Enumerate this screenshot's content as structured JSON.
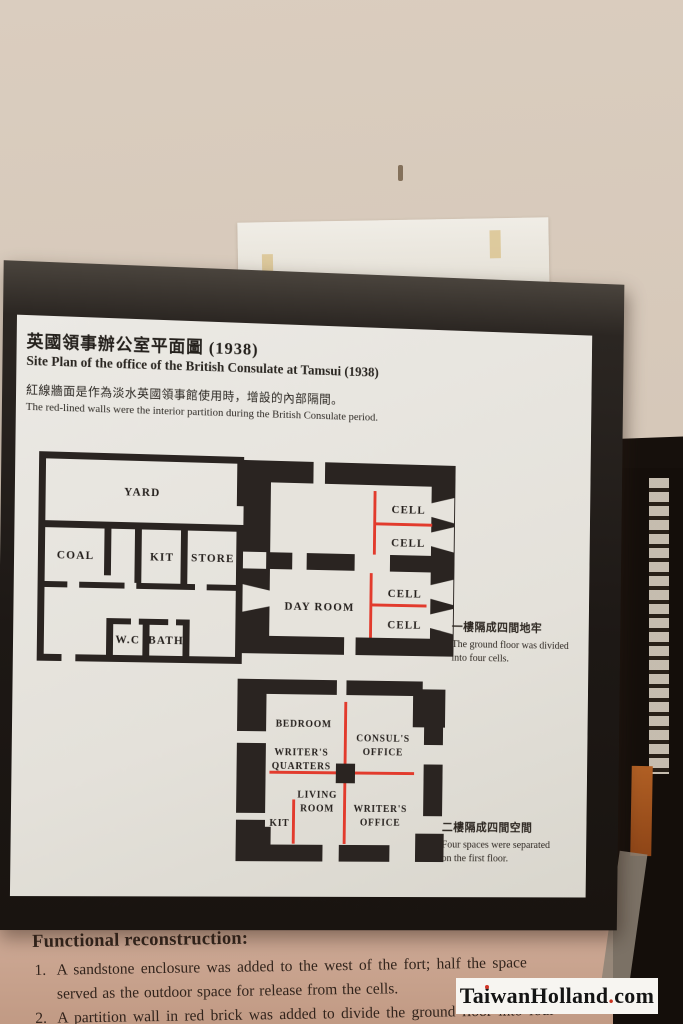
{
  "board": {
    "title_zh": "英國領事辦公室平面圖 (1938)",
    "title_en": "Site Plan  of the office of the British Consulate at Tamsui (1938)",
    "subtitle_zh": "紅線牆面是作為淡水英國領事館使用時，增設的內部隔間。",
    "subtitle_en": "The red-lined walls were  the interior partition during the British Consulate period.",
    "ground_floor": {
      "yard": "YARD",
      "coal": "COAL",
      "kit": "KIT",
      "store": "STORE",
      "wc": "W.C",
      "bath": "BATH",
      "day_room": "DAY ROOM",
      "cell": "CELL"
    },
    "first_floor": {
      "bedroom": "BEDROOM",
      "consuls_office_line1": "CONSUL'S",
      "consuls_office_line2": "OFFICE",
      "writers_quarters_line1": "WRITER'S",
      "writers_quarters_line2": "QUARTERS",
      "living_room_line1": "LIVING",
      "living_room_line2": "ROOM",
      "kit": "KIT",
      "writers_office_line1": "WRITER'S",
      "writers_office_line2": "OFFICE"
    },
    "caption_ground": {
      "zh": "一樓隔成四間地牢",
      "en": "The ground floor was divided into four cells."
    },
    "caption_first": {
      "zh": "二樓隔成四間空間",
      "en": "Four spaces were separated on the first floor."
    }
  },
  "bottom_panel": {
    "heading": "Functional reconstruction:",
    "item1_number": "1.",
    "item1_line1": "A sandstone enclosure was added to the west of the fort; half the space",
    "item1_line2": "served as the outdoor space for release from the cells.",
    "item2_number": "2.",
    "item2_line1": "A partition wall in red brick was added to divide the ground floor into four"
  },
  "watermark": {
    "pre": "Ta",
    "i_letter": "i",
    "mid": "wanHolland",
    "dot": ".",
    "post": "com"
  },
  "colors": {
    "wall_beige": "#d6c8b9",
    "frame_black": "#1d1815",
    "panel_white": "#e8e6e1",
    "plan_wall_black": "#2a2421",
    "partition_red": "#e23b2d",
    "bottom_panel_pink": "#c9a48e",
    "watermark_red": "#d23527"
  }
}
